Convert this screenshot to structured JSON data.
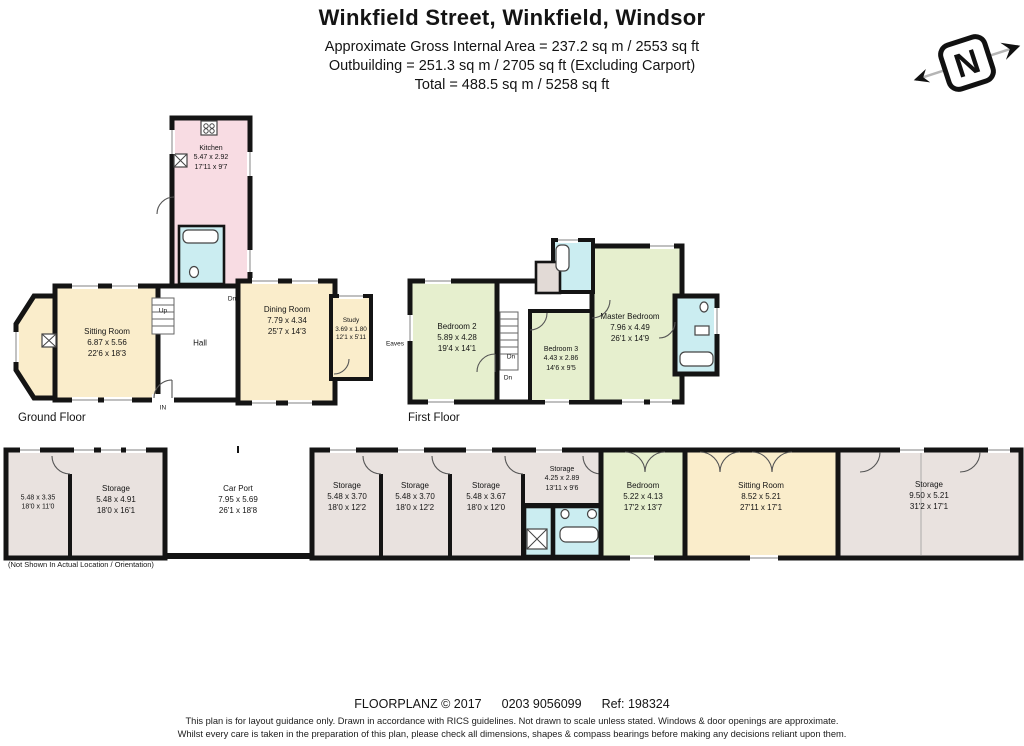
{
  "header": {
    "title": "Winkfield Street, Winkfield, Windsor",
    "area_line1": "Approximate Gross Internal Area = 237.2 sq m / 2553 sq ft",
    "area_line2": "Outbuilding = 251.3 sq m / 2705 sq ft (Excluding Carport)",
    "area_line3": "Total = 488.5 sq m / 5258 sq ft"
  },
  "compass": {
    "label": "N"
  },
  "ground_floor": {
    "label": "Ground Floor",
    "rooms": {
      "kitchen": {
        "name": "Kitchen",
        "metric": "5.47 x 2.92",
        "imperial": "17'11 x 9'7"
      },
      "sitting_room": {
        "name": "Sitting Room",
        "metric": "6.87 x 5.56",
        "imperial": "22'6 x 18'3"
      },
      "hall": {
        "name": "Hall"
      },
      "dining_room": {
        "name": "Dining Room",
        "metric": "7.79 x 4.34",
        "imperial": "25'7 x 14'3"
      },
      "study": {
        "name": "Study",
        "metric": "3.69 x 1.80",
        "imperial": "12'1 x 5'11"
      }
    },
    "markers": {
      "up": "Up",
      "in": "IN",
      "dn": "Dn"
    }
  },
  "first_floor": {
    "label": "First Floor",
    "rooms": {
      "bedroom2": {
        "name": "Bedroom 2",
        "metric": "5.89 x 4.28",
        "imperial": "19'4 x 14'1"
      },
      "bedroom3": {
        "name": "Bedroom 3",
        "metric": "4.43 x 2.86",
        "imperial": "14'6 x 9'5"
      },
      "master": {
        "name": "Master Bedroom",
        "metric": "7.96 x 4.49",
        "imperial": "26'1 x 14'9"
      }
    },
    "markers": {
      "dn1": "Dn",
      "dn2": "Dn",
      "eaves": "Eaves"
    }
  },
  "outbuilding": {
    "note": "(Not Shown In Actual Location / Orientation)",
    "rooms": {
      "room1": {
        "metric": "5.48 x 3.35",
        "imperial": "18'0 x 11'0"
      },
      "storage1": {
        "name": "Storage",
        "metric": "5.48 x 4.91",
        "imperial": "18'0 x 16'1"
      },
      "carport": {
        "name": "Car Port",
        "metric": "7.95 x 5.69",
        "imperial": "26'1 x 18'8"
      },
      "storage2": {
        "name": "Storage",
        "metric": "5.48 x 3.70",
        "imperial": "18'0 x 12'2"
      },
      "storage3": {
        "name": "Storage",
        "metric": "5.48 x 3.70",
        "imperial": "18'0 x 12'2"
      },
      "storage4": {
        "name": "Storage",
        "metric": "5.48 x 3.67",
        "imperial": "18'0 x 12'0"
      },
      "storage5": {
        "name": "Storage",
        "metric": "4.25 x 2.89",
        "imperial": "13'11 x 9'6"
      },
      "bedroom": {
        "name": "Bedroom",
        "metric": "5.22 x 4.13",
        "imperial": "17'2 x 13'7"
      },
      "sitting_room": {
        "name": "Sitting Room",
        "metric": "8.52 x 5.21",
        "imperial": "27'11 x 17'1"
      },
      "storage6": {
        "name": "Storage",
        "metric": "9.50 x 5.21",
        "imperial": "31'2 x 17'1"
      }
    }
  },
  "footer": {
    "brand": "FLOORPLANZ © 2017",
    "phone": "0203 9056099",
    "ref": "Ref: 198324",
    "disclaimer1": "This plan is for layout guidance only. Drawn in accordance with RICS guidelines. Not drawn to scale unless stated. Windows & door openings are approximate.",
    "disclaimer2": "Whilst every care is taken in the preparation of this plan, please check all dimensions, shapes & compass bearings before making any decisions reliant upon them."
  },
  "palette": {
    "wall": "#141414",
    "cream": "#FAEDCB",
    "pink": "#F8DCE3",
    "cyan": "#CBEDF1",
    "green": "#E6EFCE",
    "grey": "#E9E2DF",
    "taupe": "#E2DAD6",
    "white": "#FFFFFF"
  }
}
